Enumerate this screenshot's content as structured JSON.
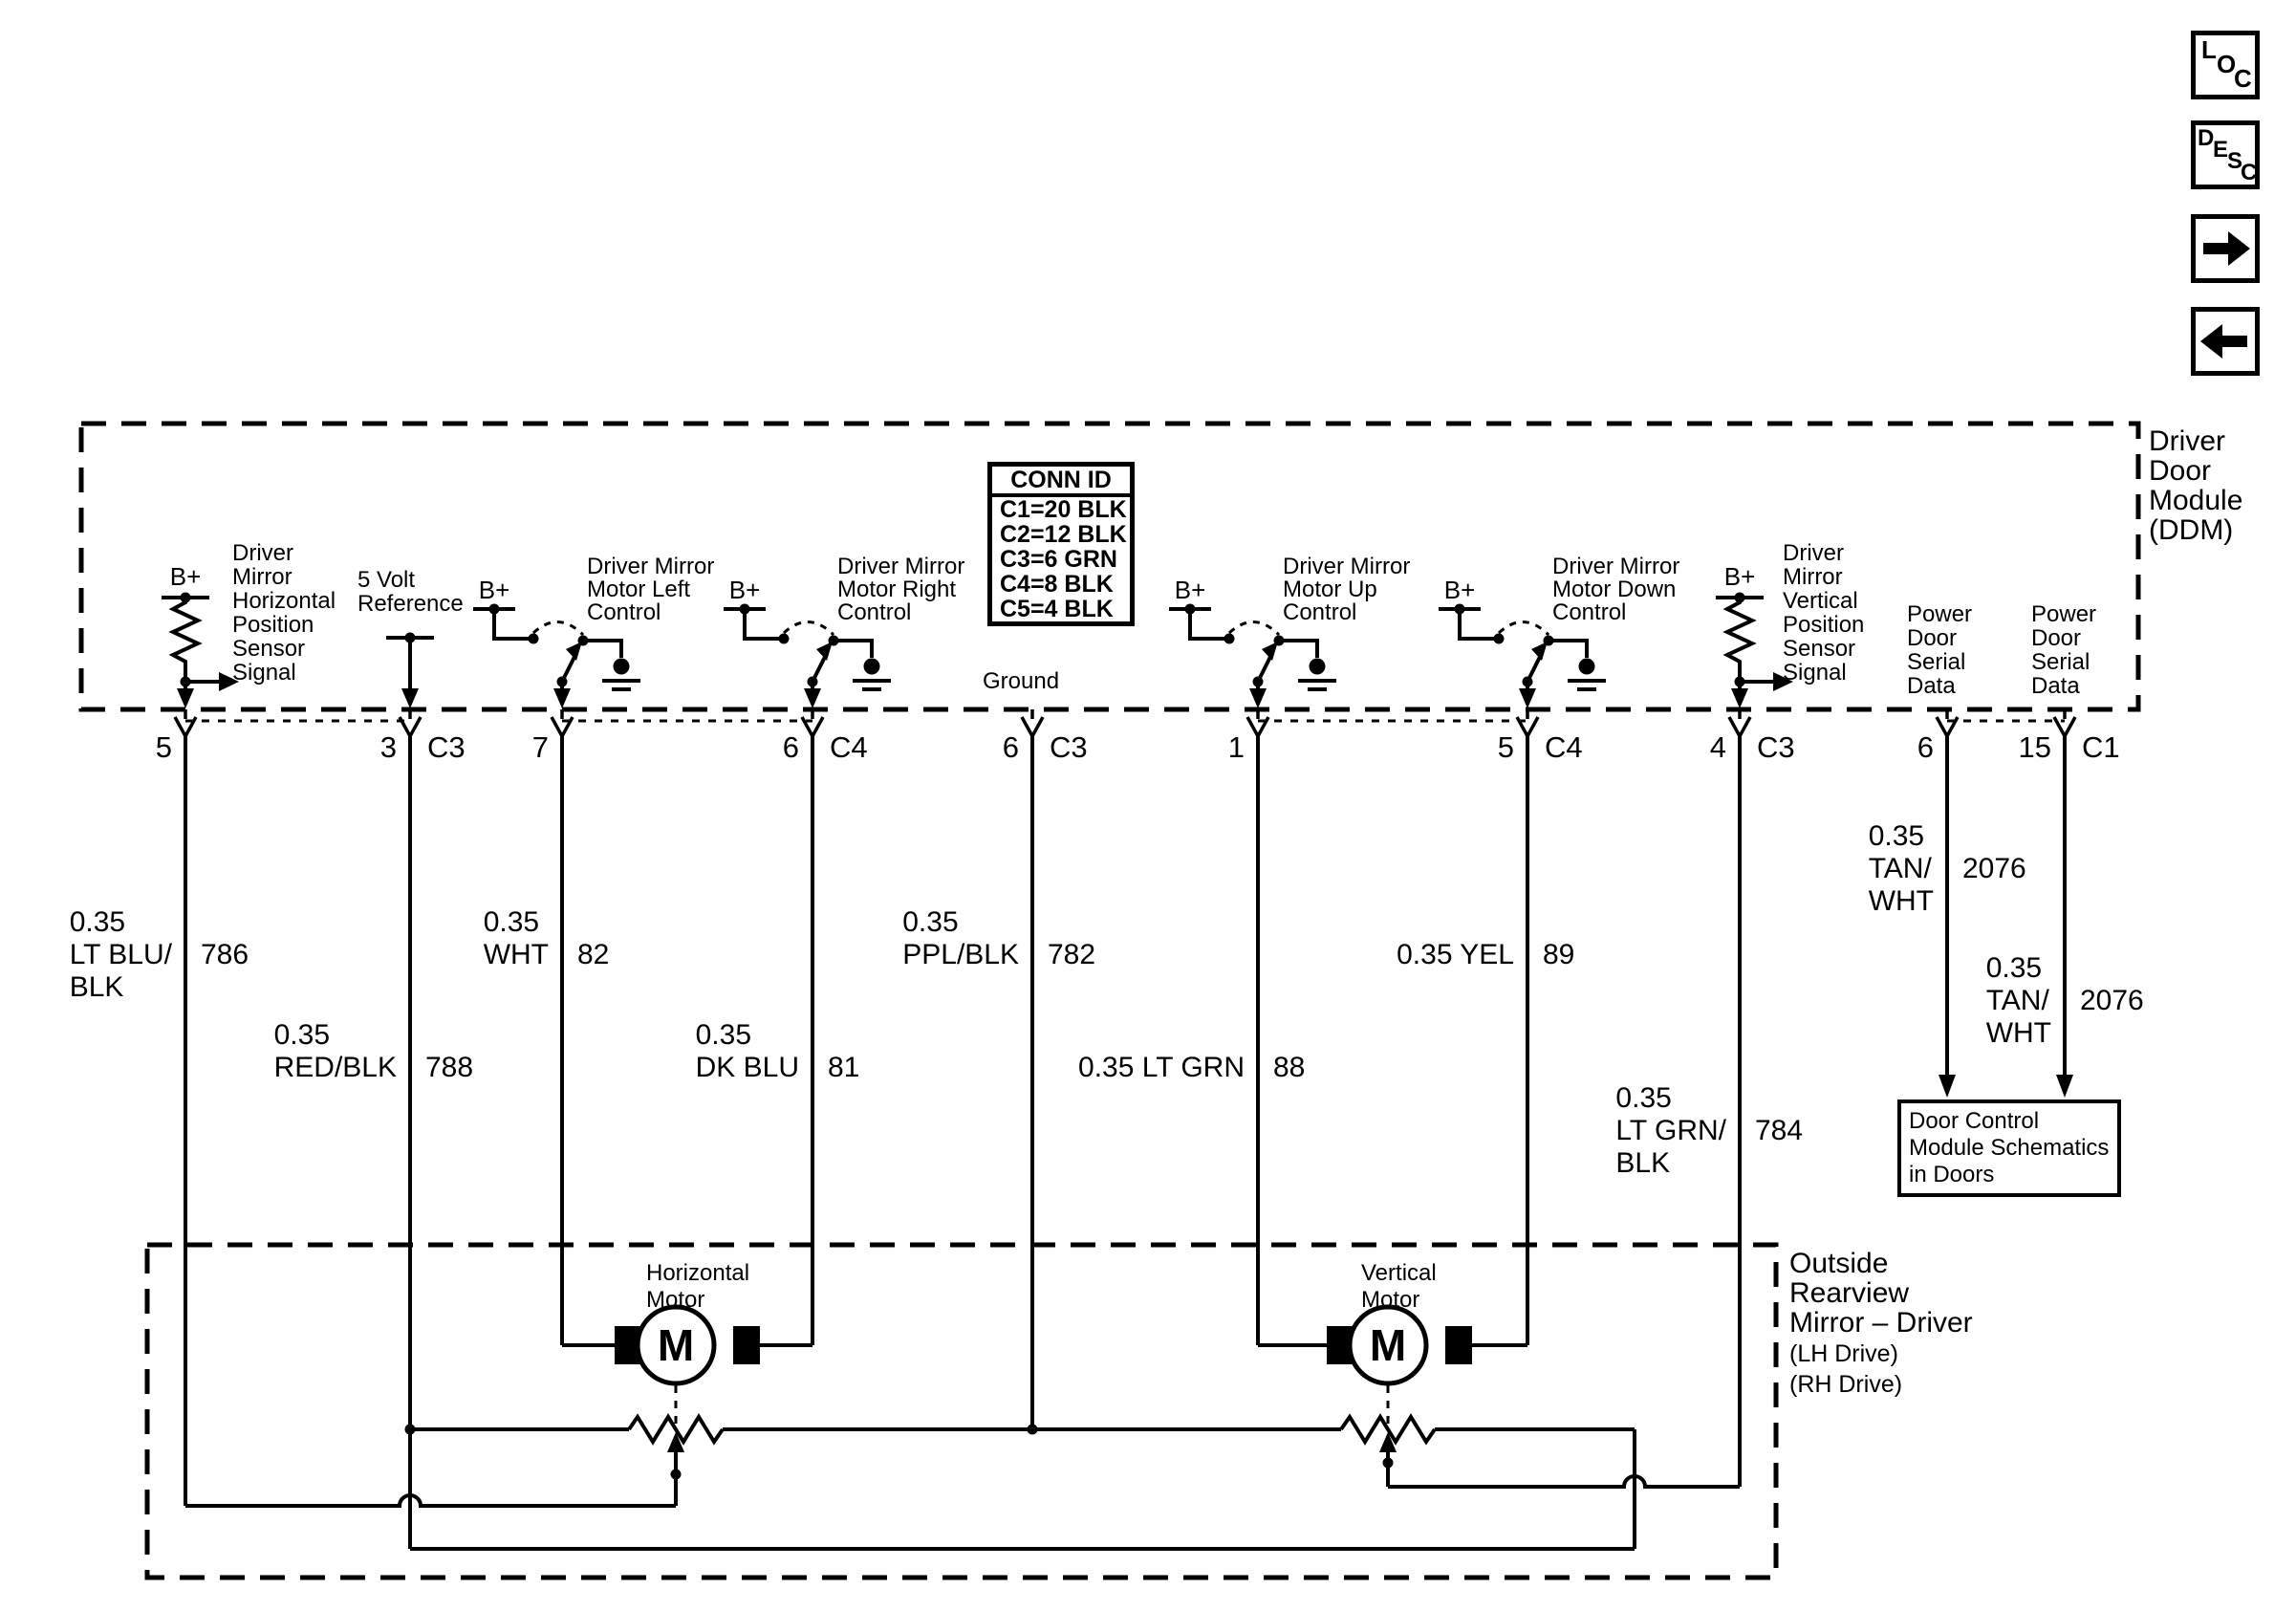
{
  "colors": {
    "ink": "#000000",
    "paper": "#ffffff"
  },
  "nav": {
    "loc_letters": [
      "L",
      "O",
      "C"
    ],
    "desc_letters": [
      "D",
      "E",
      "S",
      "C"
    ]
  },
  "ddm": {
    "title_lines": [
      "Driver",
      "Door",
      "Module",
      "(DDM)"
    ]
  },
  "conn_id": {
    "header": "CONN ID",
    "rows": [
      "C1=20 BLK",
      "C2=12 BLK",
      "C3=6 GRN",
      "C4=8 BLK",
      "C5=4 BLK"
    ]
  },
  "labels": {
    "bplus": "B+",
    "sensor_h": [
      "Driver",
      "Mirror",
      "Horizontal",
      "Position",
      "Sensor",
      "Signal"
    ],
    "five_volt": [
      "5 Volt",
      "Reference"
    ],
    "sw_left": [
      "Driver Mirror",
      "Motor Left",
      "Control"
    ],
    "sw_right": [
      "Driver Mirror",
      "Motor Right",
      "Control"
    ],
    "sw_up": [
      "Driver Mirror",
      "Motor Up",
      "Control"
    ],
    "sw_down": [
      "Driver Mirror",
      "Motor Down",
      "Control"
    ],
    "ground": "Ground",
    "sensor_v": [
      "Driver",
      "Mirror",
      "Vertical",
      "Position",
      "Sensor",
      "Signal"
    ],
    "serial": [
      "Power",
      "Door",
      "Serial",
      "Data"
    ]
  },
  "pins": {
    "s5": {
      "n": "5"
    },
    "s3": {
      "n": "3",
      "c": "C3"
    },
    "s7": {
      "n": "7"
    },
    "s6a": {
      "n": "6",
      "c": "C4"
    },
    "s6b": {
      "n": "6",
      "c": "C3"
    },
    "s1": {
      "n": "1"
    },
    "s5b": {
      "n": "5",
      "c": "C4"
    },
    "s4": {
      "n": "4",
      "c": "C3"
    },
    "s6c": {
      "n": "6"
    },
    "s15": {
      "n": "15",
      "c": "C1"
    }
  },
  "wires": {
    "w1": {
      "l1": "0.35",
      "l2": "LT BLU/",
      "l3": "BLK",
      "num": "786"
    },
    "w2": {
      "l1": "0.35",
      "l2": "RED/BLK",
      "num": "788"
    },
    "w3": {
      "l1": "0.35",
      "l2": "WHT",
      "num": "82"
    },
    "w4": {
      "l1": "0.35",
      "l2": "DK BLU",
      "num": "81"
    },
    "w5": {
      "l1": "0.35",
      "l2": "PPL/BLK",
      "num": "782"
    },
    "w6": {
      "l1": "0.35 LT GRN",
      "num": "88"
    },
    "w7": {
      "l1": "0.35 YEL",
      "num": "89"
    },
    "w8": {
      "l1": "0.35",
      "l2": "LT GRN/",
      "l3": "BLK",
      "num": "784"
    },
    "w9": {
      "l1": "0.35",
      "l2": "TAN/",
      "l3": "WHT",
      "num": "2076"
    },
    "w10": {
      "l1": "0.35",
      "l2": "TAN/",
      "l3": "WHT",
      "num": "2076"
    }
  },
  "mirror": {
    "title_lines": [
      "Outside",
      "Rearview",
      "Mirror – Driver"
    ],
    "sub_lines": [
      "(LH Drive)",
      "(RH Drive)"
    ],
    "motor_h": [
      "Horizontal",
      "Motor"
    ],
    "motor_v": [
      "Vertical",
      "Motor"
    ],
    "motor_letter": "M"
  },
  "door_box_lines": [
    "Door Control",
    "Module Schematics",
    "in Doors"
  ]
}
